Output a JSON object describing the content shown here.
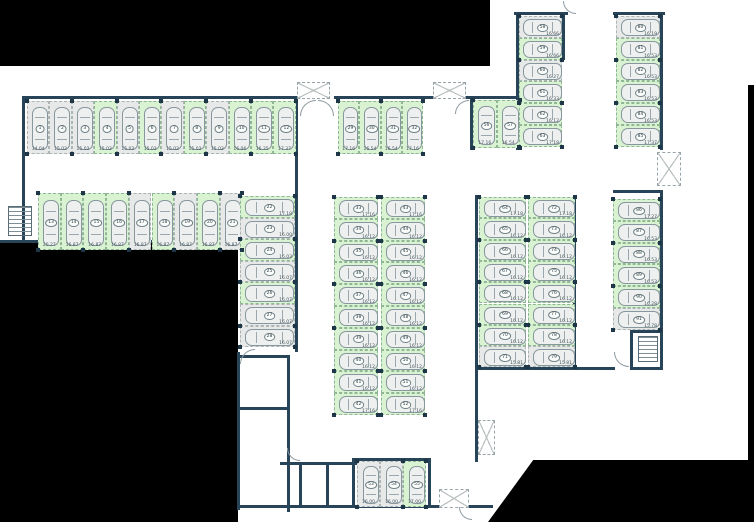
{
  "floorplan": {
    "background_color": "#ffffff",
    "wall_color": "#284459",
    "free_space_color": "#d9f3d2",
    "occupied_space_color": "#e7e9e9",
    "black_regions": [
      [
        0,
        0,
        490,
        66
      ],
      [
        0,
        243,
        238,
        279
      ],
      [
        748,
        85,
        6,
        377
      ]
    ],
    "black_polygon": {
      "x": 488,
      "y": 460,
      "w": 266,
      "h": 62,
      "clip": "polygon(0% 100%,17% 0%,100% 0%,100% 100%)"
    },
    "walls": [
      [
        22,
        96,
        278,
        3
      ],
      [
        334,
        96,
        188,
        3
      ],
      [
        514,
        12,
        54,
        3
      ],
      [
        613,
        12,
        52,
        3
      ],
      [
        22,
        96,
        3,
        147
      ],
      [
        0,
        240,
        240,
        3
      ],
      [
        295,
        96,
        3,
        256
      ],
      [
        470,
        96,
        3,
        54
      ],
      [
        516,
        15,
        3,
        135
      ],
      [
        562,
        12,
        3,
        48
      ],
      [
        660,
        15,
        3,
        135
      ],
      [
        613,
        190,
        50,
        3
      ],
      [
        660,
        190,
        3,
        140
      ],
      [
        475,
        195,
        3,
        175
      ],
      [
        573,
        195,
        3,
        175
      ],
      [
        475,
        367,
        140,
        3
      ],
      [
        475,
        370,
        3,
        92
      ],
      [
        237,
        352,
        3,
        158
      ],
      [
        287,
        355,
        3,
        157
      ],
      [
        237,
        355,
        53,
        3
      ],
      [
        237,
        407,
        53,
        3
      ],
      [
        237,
        505,
        256,
        3
      ],
      [
        352,
        458,
        79,
        3
      ],
      [
        352,
        458,
        3,
        49
      ],
      [
        428,
        458,
        3,
        49
      ],
      [
        280,
        462,
        78,
        3
      ],
      [
        299,
        463,
        3,
        43
      ],
      [
        326,
        463,
        3,
        43
      ],
      [
        630,
        330,
        33,
        3
      ],
      [
        630,
        330,
        3,
        40
      ],
      [
        660,
        330,
        3,
        40
      ],
      [
        630,
        367,
        33,
        3
      ]
    ],
    "shafts": [
      [
        297,
        82,
        33,
        17
      ],
      [
        433,
        82,
        33,
        17
      ],
      [
        657,
        152,
        24,
        34
      ],
      [
        478,
        420,
        17,
        35
      ],
      [
        439,
        489,
        30,
        19
      ]
    ],
    "stairs": [
      [
        8,
        206,
        24,
        30
      ],
      [
        638,
        336,
        20,
        26
      ]
    ],
    "doors": [
      {
        "x": 300,
        "y": 100,
        "r": 16,
        "corner": "tl"
      },
      {
        "x": 318,
        "y": 100,
        "r": 16,
        "corner": "tr"
      },
      {
        "x": 455,
        "y": 100,
        "r": 14,
        "corner": "tl"
      },
      {
        "x": 563,
        "y": 1,
        "r": 13,
        "corner": "bl"
      },
      {
        "x": 240,
        "y": 349,
        "r": 15,
        "corner": "tl"
      },
      {
        "x": 614,
        "y": 352,
        "r": 15,
        "corner": "bl"
      },
      {
        "x": 287,
        "y": 448,
        "r": 13,
        "corner": "bl"
      },
      {
        "x": 459,
        "y": 507,
        "r": 13,
        "corner": "bl"
      }
    ]
  },
  "groups": [
    {
      "id": "row-01-12",
      "kind": "row",
      "x": 27,
      "y": 101,
      "sw": 22.4,
      "sh": 53,
      "spaces": [
        {
          "n": "1",
          "size": "14.04",
          "free": false
        },
        {
          "n": "2",
          "size": "15.02",
          "free": false
        },
        {
          "n": "3",
          "size": "15.02",
          "free": false
        },
        {
          "n": "4",
          "size": "15.02",
          "free": true
        },
        {
          "n": "5",
          "size": "15.02",
          "free": false
        },
        {
          "n": "6",
          "size": "15.02",
          "free": true
        },
        {
          "n": "7",
          "size": "15.02",
          "free": false
        },
        {
          "n": "8",
          "size": "15.02",
          "free": true
        },
        {
          "n": "9",
          "size": "15.02",
          "free": false
        },
        {
          "n": "10",
          "size": "16.06",
          "free": true
        },
        {
          "n": "11",
          "size": "16.35",
          "free": true
        },
        {
          "n": "12",
          "size": "17.37",
          "free": true
        }
      ]
    },
    {
      "id": "row-13-21",
      "kind": "row",
      "x": 38,
      "y": 193,
      "sw": 22.7,
      "sh": 57,
      "spaces": [
        {
          "n": "13",
          "size": "20.27",
          "free": true
        },
        {
          "n": "14",
          "size": "16.87",
          "free": true
        },
        {
          "n": "15",
          "size": "16.87",
          "free": true
        },
        {
          "n": "16",
          "size": "16.87",
          "free": true
        },
        {
          "n": "17",
          "size": "16.87",
          "free": false
        },
        {
          "n": "18",
          "size": "16.87",
          "free": true
        },
        {
          "n": "19",
          "size": "16.87",
          "free": false
        },
        {
          "n": "20",
          "size": "16.87",
          "free": true
        },
        {
          "n": "21",
          "size": "16.87",
          "free": false
        }
      ]
    },
    {
      "id": "col-22-28",
      "kind": "col",
      "x": 240,
      "y": 196,
      "w": 55,
      "sh": 21.6,
      "spaces": [
        {
          "n": "22",
          "size": "17.18",
          "free": true
        },
        {
          "n": "23",
          "size": "16.00",
          "free": false
        },
        {
          "n": "24",
          "size": "16.03",
          "free": true
        },
        {
          "n": "25",
          "size": "16.07",
          "free": false
        },
        {
          "n": "26",
          "size": "16.07",
          "free": true
        },
        {
          "n": "27",
          "size": "16.07",
          "free": false
        },
        {
          "n": "28",
          "size": "16.07",
          "free": false
        }
      ]
    },
    {
      "id": "row-29-32",
      "kind": "row",
      "x": 338,
      "y": 101,
      "sw": 21.3,
      "sh": 53,
      "spaces": [
        {
          "n": "29",
          "size": "17.16",
          "free": true
        },
        {
          "n": "30",
          "size": "16.54",
          "free": true
        },
        {
          "n": "31",
          "size": "16.54",
          "free": true
        },
        {
          "n": "32",
          "size": "17.16",
          "free": true
        }
      ]
    },
    {
      "id": "col-33-42",
      "kind": "col",
      "x": 334,
      "y": 197,
      "w": 44,
      "sh": 21.8,
      "spaces": [
        {
          "n": "33",
          "size": "17.16",
          "free": true
        },
        {
          "n": "34",
          "size": "16.12",
          "free": true
        },
        {
          "n": "35",
          "size": "16.12",
          "free": true
        },
        {
          "n": "36",
          "size": "16.12",
          "free": true
        },
        {
          "n": "37",
          "size": "16.12",
          "free": true
        },
        {
          "n": "38",
          "size": "16.12",
          "free": true
        },
        {
          "n": "39",
          "size": "16.12",
          "free": true
        },
        {
          "n": "40",
          "size": "16.12",
          "free": true
        },
        {
          "n": "41",
          "size": "16.12",
          "free": true
        },
        {
          "n": "42",
          "size": "17.16",
          "free": true
        }
      ]
    },
    {
      "id": "col-43-52",
      "kind": "col",
      "x": 381,
      "y": 197,
      "w": 44,
      "sh": 21.8,
      "spaces": [
        {
          "n": "43",
          "size": "17.16",
          "free": true
        },
        {
          "n": "44",
          "size": "16.12",
          "free": true
        },
        {
          "n": "45",
          "size": "16.12",
          "free": true
        },
        {
          "n": "46",
          "size": "16.12",
          "free": true
        },
        {
          "n": "47",
          "size": "16.12",
          "free": true
        },
        {
          "n": "48",
          "size": "16.12",
          "free": true
        },
        {
          "n": "49",
          "size": "16.12",
          "free": true
        },
        {
          "n": "50",
          "size": "16.12",
          "free": true
        },
        {
          "n": "51",
          "size": "16.12",
          "free": true
        },
        {
          "n": "52",
          "size": "17.16",
          "free": true
        }
      ]
    },
    {
      "id": "row-53-55",
      "kind": "row",
      "x": 357,
      "y": 461,
      "sw": 23,
      "sh": 46,
      "spaces": [
        {
          "n": "53",
          "size": "16.00",
          "free": false
        },
        {
          "n": "54",
          "size": "16.00",
          "free": false
        },
        {
          "n": "55",
          "size": "17.00",
          "free": true
        }
      ]
    },
    {
      "id": "row-56-57",
      "kind": "row",
      "x": 473,
      "y": 100,
      "sw": 23.5,
      "sh": 48,
      "spaces": [
        {
          "n": "56",
          "size": "17.16",
          "free": true
        },
        {
          "n": "57",
          "size": "16.54",
          "free": true
        }
      ]
    },
    {
      "id": "col-58-63",
      "kind": "col",
      "x": 519,
      "y": 16,
      "w": 43,
      "sh": 21.8,
      "spaces": [
        {
          "n": "58",
          "size": "16.66",
          "free": false
        },
        {
          "n": "59",
          "size": "16.66",
          "free": true
        },
        {
          "n": "60",
          "size": "16.27",
          "free": false
        },
        {
          "n": "61",
          "size": "16.33",
          "free": true
        },
        {
          "n": "62",
          "size": "16.12",
          "free": true
        },
        {
          "n": "63",
          "size": "17.18",
          "free": true
        }
      ]
    },
    {
      "id": "col-80-85",
      "kind": "col",
      "x": 616,
      "y": 16,
      "w": 44,
      "sh": 21.8,
      "spaces": [
        {
          "n": "80",
          "size": "16.19",
          "free": false
        },
        {
          "n": "81",
          "size": "16.53",
          "free": true
        },
        {
          "n": "82",
          "size": "16.53",
          "free": true
        },
        {
          "n": "83",
          "size": "16.53",
          "free": true
        },
        {
          "n": "84",
          "size": "16.53",
          "free": true
        },
        {
          "n": "85",
          "size": "17.37",
          "free": true
        }
      ]
    },
    {
      "id": "col-64-71",
      "kind": "col",
      "x": 479,
      "y": 197,
      "w": 47,
      "sh": 21.3,
      "spaces": [
        {
          "n": "64",
          "size": "17.18",
          "free": true
        },
        {
          "n": "65",
          "size": "16.12",
          "free": true
        },
        {
          "n": "66",
          "size": "16.12",
          "free": true
        },
        {
          "n": "67",
          "size": "16.12",
          "free": true
        },
        {
          "n": "68",
          "size": "16.12",
          "free": true
        },
        {
          "n": "69",
          "size": "16.12",
          "free": true
        },
        {
          "n": "70",
          "size": "16.12",
          "free": true
        },
        {
          "n": "71",
          "size": "15.81",
          "free": false
        }
      ]
    },
    {
      "id": "col-72-79",
      "kind": "col",
      "x": 528,
      "y": 197,
      "w": 47,
      "sh": 21.3,
      "spaces": [
        {
          "n": "72",
          "size": "17.18",
          "free": true
        },
        {
          "n": "73",
          "size": "16.12",
          "free": true
        },
        {
          "n": "74",
          "size": "16.12",
          "free": true
        },
        {
          "n": "75",
          "size": "16.12",
          "free": true
        },
        {
          "n": "76",
          "size": "16.12",
          "free": true
        },
        {
          "n": "77",
          "size": "16.12",
          "free": true
        },
        {
          "n": "78",
          "size": "16.12",
          "free": true
        },
        {
          "n": "79",
          "size": "15.81",
          "free": false
        }
      ]
    },
    {
      "id": "col-86-91",
      "kind": "col",
      "x": 613,
      "y": 199,
      "w": 47,
      "sh": 21.8,
      "spaces": [
        {
          "n": "86",
          "size": "17.27",
          "free": true
        },
        {
          "n": "87",
          "size": "16.53",
          "free": true
        },
        {
          "n": "88",
          "size": "16.53",
          "free": true
        },
        {
          "n": "89",
          "size": "16.53",
          "free": true
        },
        {
          "n": "90",
          "size": "16.28",
          "free": true
        },
        {
          "n": "91",
          "size": "15.78",
          "free": false
        }
      ]
    }
  ]
}
